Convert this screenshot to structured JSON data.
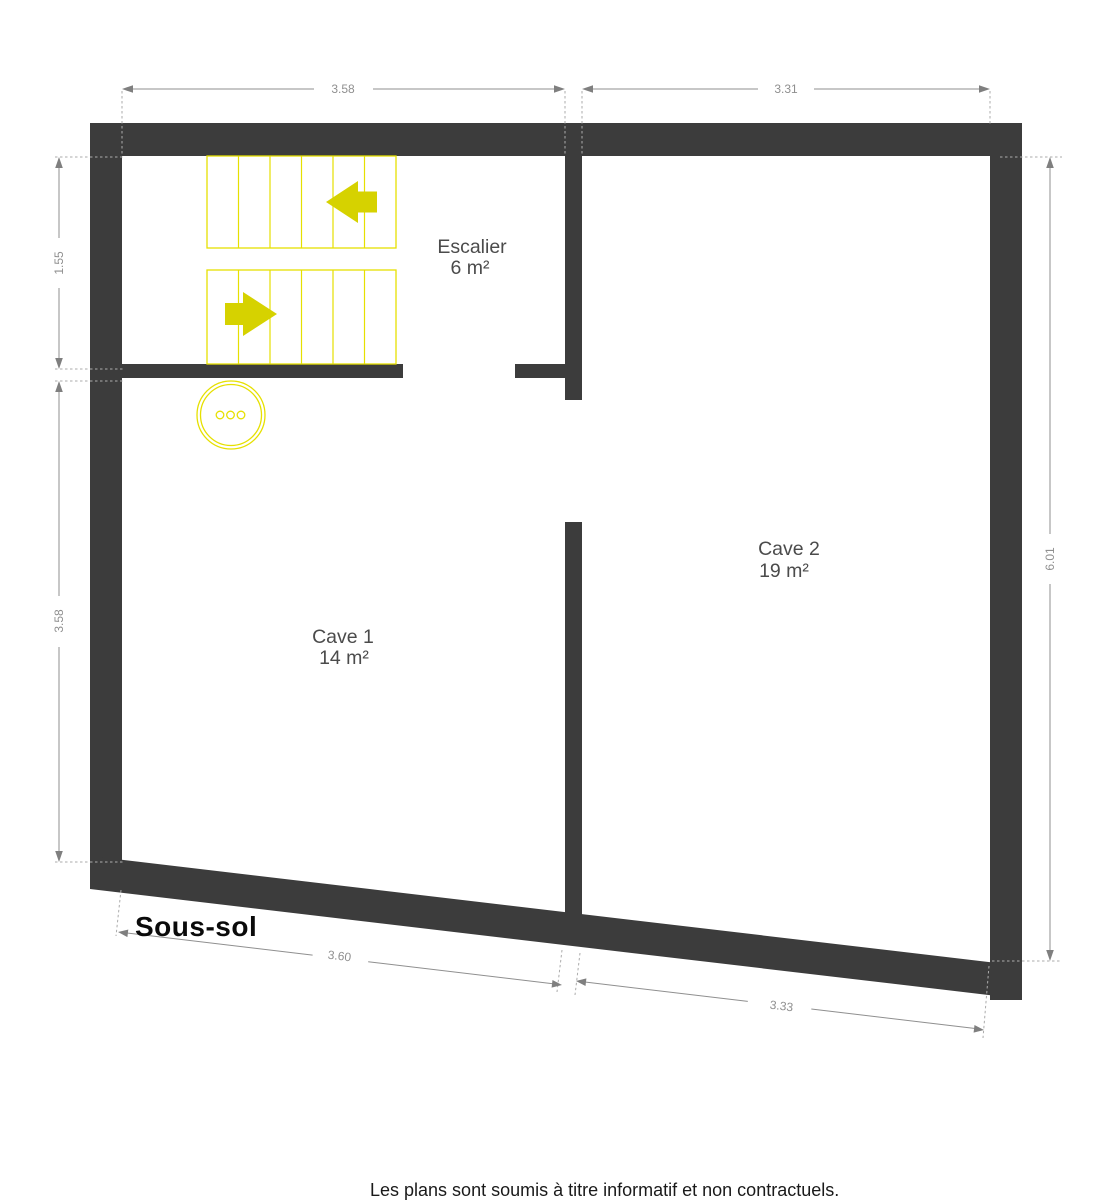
{
  "plan": {
    "floor_label": "Sous-sol",
    "disclaimer": "Les plans sont soumis à titre informatif et non contractuels.",
    "rooms": {
      "escalier": {
        "name": "Escalier",
        "area": "6 m²"
      },
      "cave1": {
        "name": "Cave 1",
        "area": "14 m²"
      },
      "cave2": {
        "name": "Cave 2",
        "area": "19 m²"
      }
    },
    "dimensions": {
      "top_left": "3.58",
      "top_right": "3.31",
      "left_upper": "1.55",
      "left_lower": "3.58",
      "right_side": "6.01",
      "bottom_left": "3.60",
      "bottom_right": "3.33"
    },
    "colors": {
      "wall": "#3c3c3c",
      "dimension_gray": "#8f8f8f",
      "room_text": "#4b4b4b",
      "stair_yellow": "#e6e000",
      "arrow_yellow": "#d6d200"
    }
  }
}
